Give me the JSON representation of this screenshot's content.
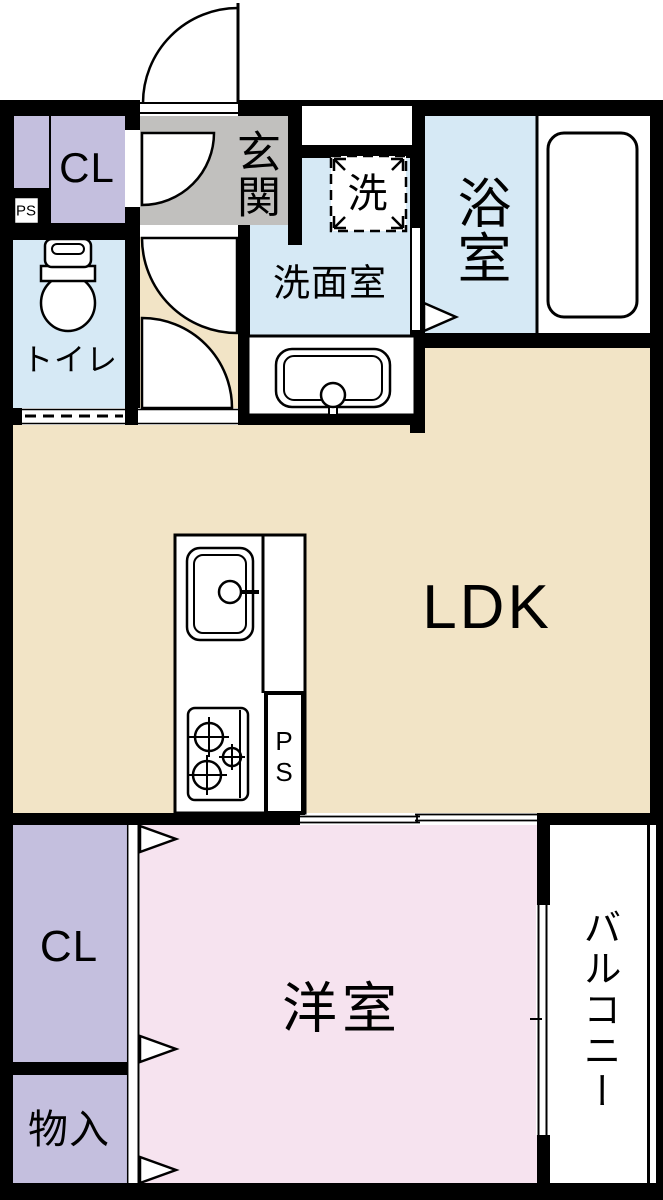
{
  "title": "1LDK apartment floor plan",
  "labels": {
    "entrance": "玄関",
    "closet_upper": "CL",
    "ps_upper": "PS",
    "toilet": "トイレ",
    "washer": "洗",
    "washroom": "洗面室",
    "bathroom": "浴室",
    "ldk": "LDK",
    "ps_kitchen": "PS",
    "closet_lower": "CL",
    "western_room": "洋室",
    "storage": "物入",
    "balcony": "バルコニー"
  },
  "colors": {
    "wall": "#000000",
    "line": "#000000",
    "floor-beige": "#F2E4C6",
    "room-blue": "#D6E9F5",
    "room-pink": "#F6E3EF",
    "room-purple": "#C4BFDE",
    "entrance-gray": "#C1C0BE",
    "bg": "#FFFFFF"
  }
}
